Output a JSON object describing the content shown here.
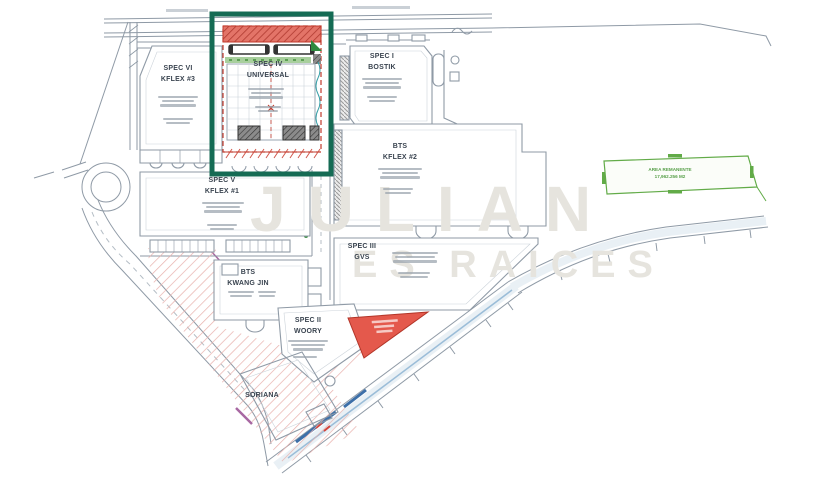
{
  "plan": {
    "watermark": {
      "line1": "JULIAN",
      "line2": "ES RAICES"
    },
    "buildings": [
      {
        "id": "spec-vi",
        "line1": "SPEC VI",
        "line2": "KFLEX #3"
      },
      {
        "id": "spec-iv",
        "line1": "SPEC IV",
        "line2": "UNIVERSAL"
      },
      {
        "id": "spec-i",
        "line1": "SPEC I",
        "line2": "BOSTIK"
      },
      {
        "id": "bts-kflex2",
        "line1": "BTS",
        "line2": "KFLEX #2"
      },
      {
        "id": "spec-v",
        "line1": "SPEC V",
        "line2": "KFLEX #1"
      },
      {
        "id": "spec-iii",
        "line1": "SPEC III",
        "line2": "GVS"
      },
      {
        "id": "bts-kwangjin",
        "line1": "BTS",
        "line2": "KWANG JIN"
      },
      {
        "id": "spec-ii",
        "line1": "SPEC II",
        "line2": "WOORY"
      },
      {
        "id": "soriana",
        "line1": "SORIANA",
        "line2": ""
      }
    ],
    "parcel": {
      "line1": "AREA REMANENTE",
      "line2": "17,962.256 M2"
    },
    "colors": {
      "highlight_box": "#156b54",
      "lot_border": "#c0392b",
      "hatch_pink": "#e49d99",
      "triangle_red": "#e4594c",
      "parcel_green": "#62ab48",
      "road_blue": "#3d6fa8",
      "linework_gray": "#8f9aa6"
    }
  }
}
